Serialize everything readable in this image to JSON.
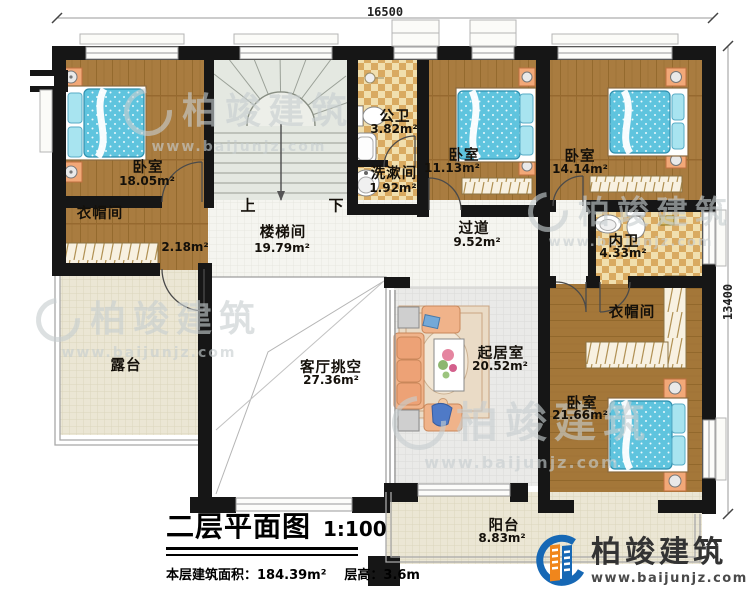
{
  "plan": {
    "dimensions": {
      "top": "16500",
      "right": "13400"
    },
    "stairs": {
      "up": "上",
      "down": "下"
    },
    "rooms": {
      "bedroom_tl": {
        "name": "卧室",
        "area": "18.05m²"
      },
      "cloakroom_l": {
        "name": "衣帽间",
        "area": "2.18m²"
      },
      "stairwell": {
        "name": "楼梯间",
        "area": "19.79m²"
      },
      "public_bath": {
        "name": "公卫",
        "area": "3.82m²"
      },
      "washroom": {
        "name": "洗漱间",
        "area": "1.92m²"
      },
      "bedroom_tm": {
        "name": "卧室",
        "area": "11.13m²"
      },
      "corridor": {
        "name": "过道",
        "area": "9.52m²"
      },
      "bedroom_tr": {
        "name": "卧室",
        "area": "14.14m²"
      },
      "master_bath": {
        "name": "内卫",
        "area": "4.33m²"
      },
      "cloakroom_r": {
        "name": "衣帽间"
      },
      "bedroom_br": {
        "name": "卧室",
        "area": "21.66m²"
      },
      "living_void": {
        "name": "客厅挑空",
        "area": "27.36m²"
      },
      "sitting_room": {
        "name": "起居室",
        "area": "20.52m²"
      },
      "terrace": {
        "name": "露台"
      },
      "balcony": {
        "name": "阳台",
        "area": "8.83m²"
      }
    },
    "title_block": {
      "title": "二层平面图",
      "scale": "1:100",
      "area_info": "本层建筑面积：184.39m²",
      "height_info": "层高：3.6m"
    },
    "branding": {
      "company": "柏竣建筑",
      "website": "www.baijunjz.com"
    },
    "watermark": {
      "company": "柏竣建筑",
      "website": "www.baijunjz.com"
    },
    "colors": {
      "wall": "#161616",
      "wood_floor": "#a97c40",
      "tile": "#d9aa61",
      "bed_blue": "#5fc4de",
      "brand_blue": "#1668b5",
      "brand_orange": "#f0861c"
    }
  }
}
